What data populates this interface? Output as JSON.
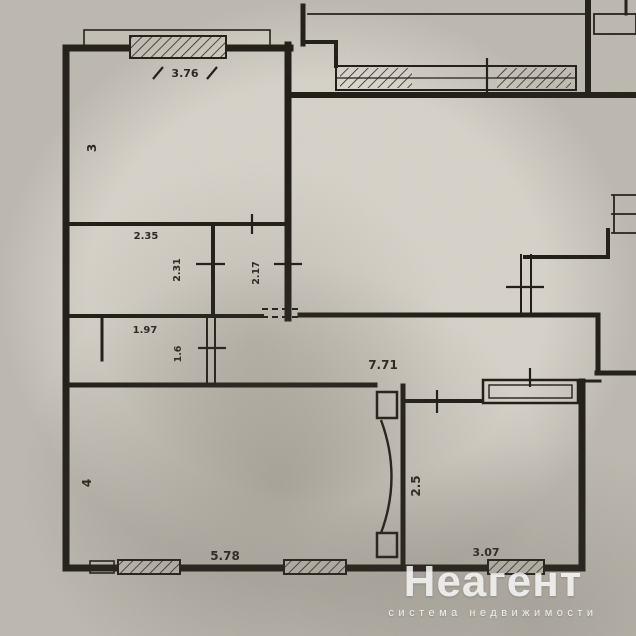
{
  "plan": {
    "labels": [
      {
        "id": "top-room-width",
        "text": "3.76"
      },
      {
        "id": "top-room-height",
        "text": "3"
      },
      {
        "id": "bath-width",
        "text": "2.35"
      },
      {
        "id": "bath-height",
        "text": "2.31"
      },
      {
        "id": "wc-height",
        "text": "2.17"
      },
      {
        "id": "niche-width",
        "text": "1.97"
      },
      {
        "id": "niche-height",
        "text": "1.6"
      },
      {
        "id": "hallway-area",
        "text": "7.71"
      },
      {
        "id": "living-room-height",
        "text": "4"
      },
      {
        "id": "living-room-width",
        "text": "5.78"
      },
      {
        "id": "bedroom-height",
        "text": "2.5"
      },
      {
        "id": "bedroom-width",
        "text": "3.07"
      }
    ]
  },
  "watermark": {
    "brand": "Неагент",
    "tagline": "система недвижимости"
  },
  "colors": {
    "paper": "#d6d2c8",
    "ink": "#221f19",
    "watermark": "#ffffff"
  }
}
